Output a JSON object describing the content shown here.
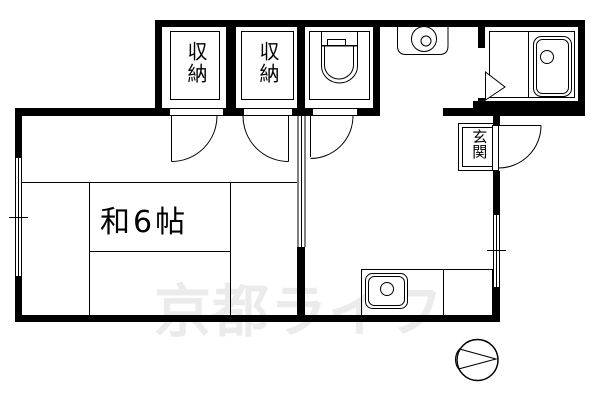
{
  "floorplan": {
    "watermark_text": "京都ライフ",
    "rooms": {
      "tatami_room": {
        "label": "和6帖"
      },
      "closet_left": {
        "label": "収納"
      },
      "closet_right": {
        "label": "収納"
      },
      "entrance": {
        "label": "玄関"
      }
    },
    "fixtures": {
      "toilet": "toilet-icon",
      "bathtub": "bathtub-icon",
      "washing_machine_pan": "washing-machine-pan-icon",
      "kitchen_sink": "kitchen-sink-icon",
      "compass": "compass-north-arrow-icon"
    },
    "colors": {
      "wall": "#000000",
      "line": "#000000",
      "watermark": "#ebebeb",
      "background": "#ffffff"
    }
  }
}
